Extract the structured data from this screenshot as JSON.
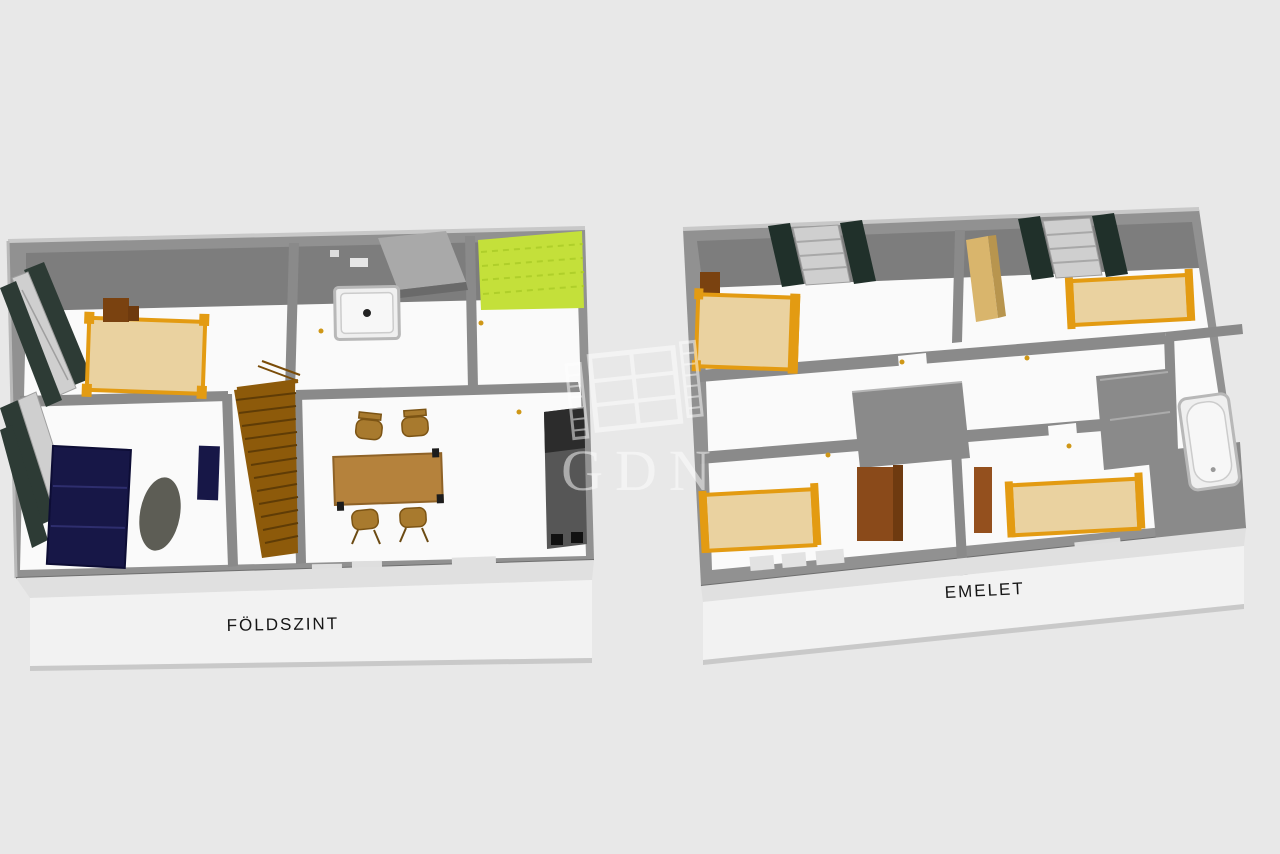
{
  "plans": [
    {
      "id": "ground-floor",
      "label": "FÖLDSZINT",
      "rooms": [
        {
          "name": "bedroom",
          "furniture": [
            "double-bed",
            "desk-chair",
            "window-shutters"
          ]
        },
        {
          "name": "bathroom",
          "furniture": [
            "shower-tray",
            "counter",
            "wall-cabinet"
          ]
        },
        {
          "name": "pantry",
          "furniture": [
            "green-floor"
          ]
        },
        {
          "name": "living-room",
          "furniture": [
            "corner-sofa",
            "armchair",
            "oval-rug",
            "window-shutters"
          ]
        },
        {
          "name": "staircase",
          "furniture": [
            "stairs",
            "railing"
          ]
        },
        {
          "name": "dining-room",
          "furniture": [
            "dining-table",
            "chair",
            "chair",
            "chair",
            "chair",
            "kitchen-unit"
          ]
        }
      ]
    },
    {
      "id": "upper-floor",
      "label": "EMELET",
      "rooms": [
        {
          "name": "bedroom-1",
          "furniture": [
            "bed",
            "dresser",
            "window-blinds",
            "window"
          ]
        },
        {
          "name": "bedroom-2",
          "furniture": [
            "bed",
            "wardrobe-tall",
            "window-blinds",
            "window"
          ]
        },
        {
          "name": "hallway",
          "furniture": []
        },
        {
          "name": "bathroom",
          "furniture": [
            "bathtub"
          ]
        },
        {
          "name": "bedroom-3",
          "furniture": [
            "bed",
            "wardrobe"
          ]
        },
        {
          "name": "bedroom-4",
          "furniture": [
            "bed",
            "wardrobe-narrow"
          ]
        }
      ]
    }
  ],
  "watermark": {
    "text": "GDN",
    "icon": "window-logo-icon",
    "opacity": 0.5
  },
  "palette": {
    "background": "#e8e8e8",
    "wall": "#919191",
    "wall-face": "#7d7d7d",
    "wall-block": "#8a8a8a",
    "wall-top": "#c8c8c8",
    "floor": "#fafafa",
    "base": "#f2f2f2",
    "base-top": "#e0e0e0",
    "shadow": "#c9c9c9",
    "bed": "#ead2a0",
    "bed-frame": "#e39b12",
    "wood-dark": "#7a4210",
    "wardrobe": "#8a4a1a",
    "wardrobe-tan": "#d9b56c",
    "table": "#b5823c",
    "chair": "#a87a2e",
    "stairs": "#8d5a0a",
    "stair-line": "#5f3c06",
    "sofa": "#171747",
    "rug": "#5d5d55",
    "shutter": "#2d3b35",
    "blind": "#20302a",
    "window-pane": "#cfcfcf",
    "green": "#c4e03a",
    "green-line": "#afcf2a",
    "appliance": "#565656",
    "appliance-dark": "#2c2c2c",
    "fixture": "#efefef",
    "fixture-edge": "#b8b8b8",
    "handle": "#cf9717",
    "label": "#161616",
    "watermark": "#ffffff"
  }
}
